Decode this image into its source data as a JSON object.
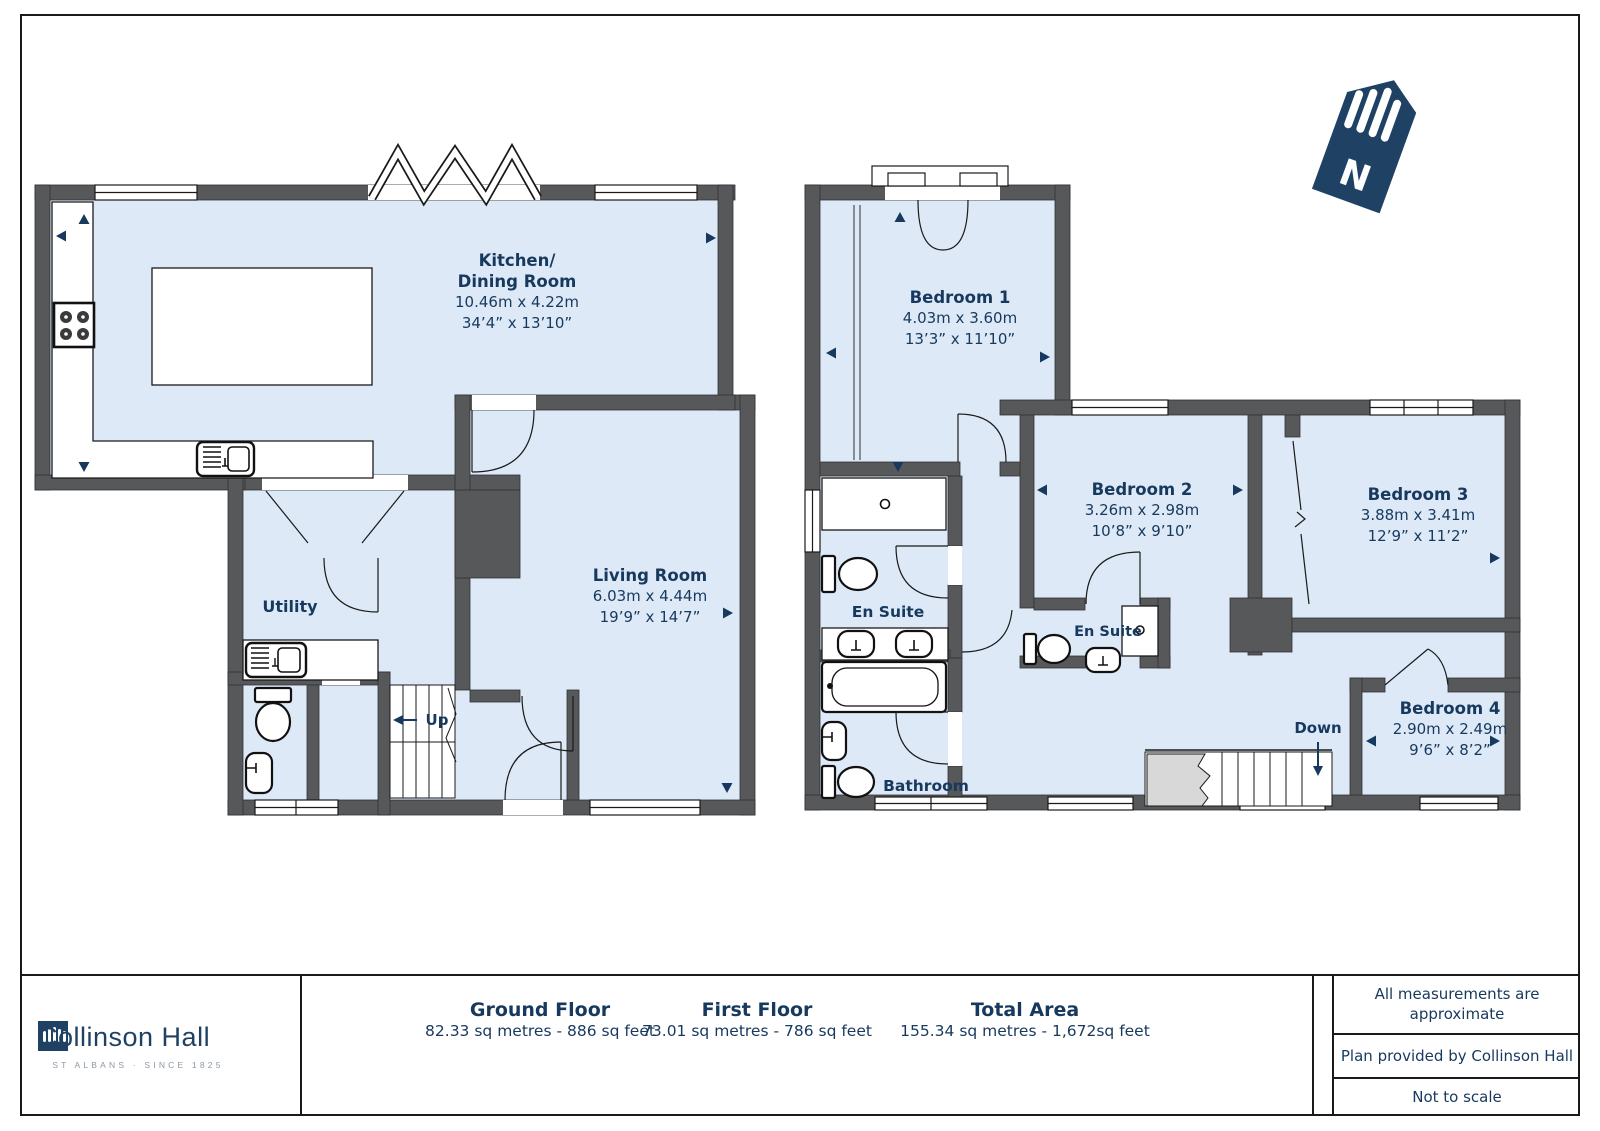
{
  "colors": {
    "navy": "#17395E",
    "wall_gray": "#57585A",
    "room_blue": "#DDE9F7",
    "void_gray": "#D8D8D8",
    "brand_navy": "#1E4164",
    "tagline_gray": "#8D98A5"
  },
  "north_label": "N",
  "ground_floor": {
    "kitchen": {
      "name_line1": "Kitchen/",
      "name_line2": "Dining Room",
      "metric": "10.46m x 4.22m",
      "imperial": "34’4” x 13’10”"
    },
    "living_room": {
      "name": "Living Room",
      "metric": "6.03m x 4.44m",
      "imperial": "19’9” x 14’7”"
    },
    "utility": {
      "name": "Utility"
    },
    "stairs_up_label": "Up"
  },
  "first_floor": {
    "bedroom1": {
      "name": "Bedroom 1",
      "metric": "4.03m x 3.60m",
      "imperial": "13’3” x 11’10”"
    },
    "bedroom2": {
      "name": "Bedroom 2",
      "metric": "3.26m x 2.98m",
      "imperial": "10’8” x 9’10”"
    },
    "bedroom3": {
      "name": "Bedroom 3",
      "metric": "3.88m x 3.41m",
      "imperial": "12’9” x 11’2”"
    },
    "bedroom4": {
      "name": "Bedroom 4",
      "metric": "2.90m x 2.49m",
      "imperial": "9’6” x 8’2”"
    },
    "ensuite1": {
      "name": "En Suite"
    },
    "ensuite2": {
      "name": "En Suite"
    },
    "bathroom": {
      "name": "Bathroom"
    },
    "stairs_down_label": "Down"
  },
  "footer": {
    "brand": {
      "name": "Collinson Hall",
      "tagline": "ST ALBANS · SINCE 1825"
    },
    "ground": {
      "title": "Ground Floor",
      "area": "82.33 sq metres - 886 sq feet"
    },
    "first": {
      "title": "First Floor",
      "area": "73.01 sq metres - 786 sq feet"
    },
    "total": {
      "title": "Total Area",
      "area": "155.34 sq metres - 1,672sq feet"
    },
    "notes": {
      "measurements": "All measurements are approximate",
      "provider": "Plan provided by Collinson Hall",
      "scale": "Not to scale"
    }
  }
}
